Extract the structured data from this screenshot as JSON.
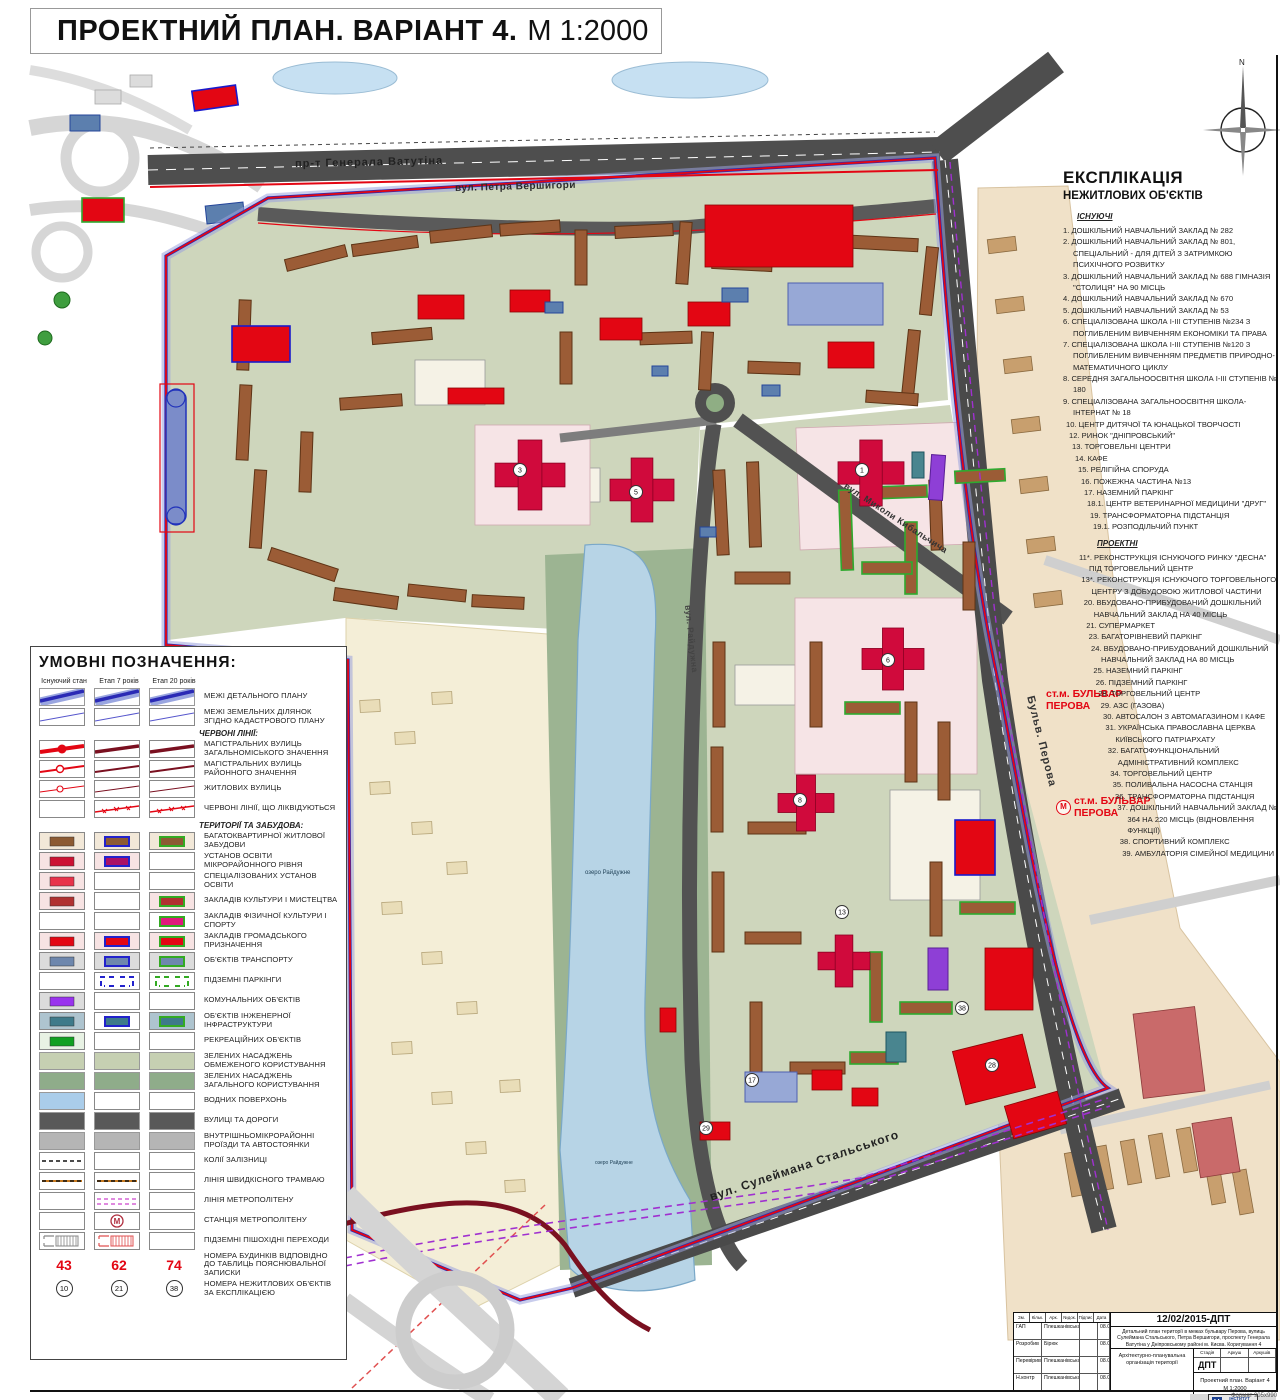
{
  "title": {
    "main": "ПРОЕКТНИЙ ПЛАН. ВАРІАНТ 4.",
    "scale": "М 1:2000"
  },
  "compass": {
    "north": "N"
  },
  "map_labels": {
    "street_vatutina": "пр-т Генерала Ватутіна",
    "street_vershygory": "вул. Петра Вершигори",
    "street_kybalchycha": "вул. Миколи Кибальчича",
    "street_raiduzhna": "вул. Райдужна",
    "street_stalskogo": "вул. Сулеймана Стальського",
    "street_perova": "Бульв. Перова",
    "lake": "озеро Райдужне",
    "metro_station_1": "ст.м. БУЛЬВАР ПЕРОВА",
    "metro_station_2": "ст.м. БУЛЬВАР ПЕРОВА",
    "metro_symbol": "М"
  },
  "map_markers": [
    "3",
    "5",
    "1",
    "6",
    "8",
    "13",
    "17",
    "28",
    "29",
    "38"
  ],
  "colors": {
    "red_line": "#e30613",
    "dark_red_line": "#7a1020",
    "blue_line": "#2222b0",
    "boundary_band": "#9aa2dd",
    "road": "#4e4e4e",
    "water": "#b7d4e6",
    "green_limited": "#c6d0b2",
    "green_public": "#8fac8a",
    "metro_dash": "#a030d0"
  },
  "legend": {
    "title": "УМОВНІ ПОЗНАЧЕННЯ:",
    "columns": [
      "Існуючий стан",
      "Етап 7 років",
      "Етап 20 років"
    ],
    "rows": [
      {
        "type": "row",
        "label": "МЕЖІ ДЕТАЛЬНОГО ПЛАНУ",
        "cells": [
          "band_blue",
          "band_blue",
          "band_blue"
        ]
      },
      {
        "type": "row",
        "label": "МЕЖІ ЗЕМЕЛЬНИХ ДІЛЯНОК ЗГІДНО КАДАСТРОВОГО ПЛАНУ",
        "cells": [
          "line_blue",
          "line_blue",
          "line_blue"
        ]
      },
      {
        "type": "header",
        "label": "ЧЕРВОНІ ЛІНІЇ:"
      },
      {
        "type": "row",
        "label": "МАГІСТРАЛЬНИХ ВУЛИЦЬ ЗАГАЛЬНОМІСЬКОГО ЗНАЧЕННЯ",
        "cells": [
          "red_major_e",
          "red_major_p",
          "red_major_p"
        ]
      },
      {
        "type": "row",
        "label": "МАГІСТРАЛЬНИХ ВУЛИЦЬ РАЙОННОГО ЗНАЧЕННЯ",
        "cells": [
          "red_district_e",
          "red_district_p",
          "red_district_p"
        ]
      },
      {
        "type": "row",
        "label": "ЖИТЛОВИХ ВУЛИЦЬ",
        "cells": [
          "red_res_e",
          "red_res_p",
          "red_res_p"
        ]
      },
      {
        "type": "row",
        "label": "ЧЕРВОНІ ЛІНІЇ, ЩО ЛІКВІДУЮТЬСЯ",
        "cells": [
          "empty",
          "red_liq",
          "red_liq"
        ]
      },
      {
        "type": "header",
        "label": "ТЕРИТОРІЇ ТА ЗАБУДОВА:"
      },
      {
        "type": "row",
        "label": "БАГАТОКВАРТИРНОЇ ЖИТЛОВОЇ ЗАБУДОВИ",
        "cells": [
          "r:#f2e8d8/#8c5a33/none",
          "r:#f2e8d8/#8c5a33/#2222cc",
          "r:#f2e8d8/#8c5a33/#33aa22"
        ]
      },
      {
        "type": "row",
        "label": "УСТАНОВ ОСВІТИ МІКРОРАЙОННОГО РІВНЯ",
        "cells": [
          "r:#f7e3e3/#cc1133/none",
          "r:#f7e3e3/#aa1166/#2222cc",
          "empty"
        ]
      },
      {
        "type": "row",
        "label": "СПЕЦІАЛІЗОВАНИХ УСТАНОВ ОСВІТИ",
        "cells": [
          "r:#f7e3e3/#e8334a/none",
          "empty",
          "empty"
        ]
      },
      {
        "type": "row",
        "label": "ЗАКЛАДІВ КУЛЬТУРИ І МИСТЕЦТВА",
        "cells": [
          "r:#f7e3e3/#b03030/none",
          "empty",
          "r:#f7e3e3/#b03030/#33aa22"
        ]
      },
      {
        "type": "row",
        "label": "ЗАКЛАДІВ ФІЗИЧНОЇ КУЛЬТУРИ І СПОРТУ",
        "cells": [
          "empty",
          "empty",
          "r:#ffffff/#e0187c/#33aa22"
        ]
      },
      {
        "type": "row",
        "label": "ЗАКЛАДІВ ГРОМАДСЬКОГО ПРИЗНАЧЕННЯ",
        "cells": [
          "r:#f7e3e3/#e30613/none",
          "r:#f7e3e3/#e30613/#2222cc",
          "r:#f7e3e3/#e30613/#33aa22"
        ]
      },
      {
        "type": "row",
        "label": "ОБ'ЄКТІВ ТРАНСПОРТУ",
        "cells": [
          "r:#dcdcdc/#6e87ad/none",
          "r:#dcdcdc/#6e87ad/#2222cc",
          "r:#dcdcdc/#6e87ad/#33aa22"
        ]
      },
      {
        "type": "row",
        "label": "ПІДЗЕМНІ ПАРКІНГИ",
        "cells": [
          "empty",
          "bracket:#2222cc",
          "bracket:#33aa22"
        ]
      },
      {
        "type": "row",
        "label": "КОМУНАЛЬНИХ ОБ'ЄКТІВ",
        "cells": [
          "r:#dcdcdc/#9933ee/none",
          "empty",
          "empty"
        ]
      },
      {
        "type": "row",
        "label": "ОБ'ЄКТІВ ІНЖЕНЕРНОЇ ІНФРАСТРУКТУРИ",
        "cells": [
          "r:#aec4cf/#3e7a8a/none",
          "r:#ffffff/#3e7a8a/#2222cc",
          "r:#aec4cf/#3e7a8a/#33aa22"
        ]
      },
      {
        "type": "row",
        "label": "РЕКРЕАЦІЙНИХ ОБ'ЄКТІВ",
        "cells": [
          "r:#e8f2e4/#11a022/none",
          "empty",
          "empty"
        ]
      },
      {
        "type": "row",
        "label": "ЗЕЛЕНИХ НАСАДЖЕНЬ ОБМЕЖЕНОГО КОРИСТУВАННЯ",
        "cells": [
          "a:#c6d0b2",
          "a:#c6d0b2",
          "a:#c6d0b2"
        ]
      },
      {
        "type": "row",
        "label": "ЗЕЛЕНИХ НАСАДЖЕНЬ ЗАГАЛЬНОГО КОРИСТУВАННЯ",
        "cells": [
          "a:#8fac8a",
          "a:#8fac8a",
          "a:#8fac8a"
        ]
      },
      {
        "type": "row",
        "label": "ВОДНИХ ПОВЕРХОНЬ",
        "cells": [
          "a:#aacdea",
          "empty",
          "empty"
        ]
      },
      {
        "type": "row",
        "label": "ВУЛИЦІ ТА ДОРОГИ",
        "cells": [
          "a:#595959",
          "a:#595959",
          "a:#595959"
        ]
      },
      {
        "type": "row",
        "label": "ВНУТРІШНЬОМІКРОРАЙОННІ ПРОЇЗДИ ТА АВТОСТОЯНКИ",
        "cells": [
          "a:#b5b5b5",
          "a:#b5b5b5",
          "a:#b5b5b5"
        ]
      },
      {
        "type": "row",
        "label": "КОЛІЇ ЗАЛІЗНИЦІ",
        "cells": [
          "rail",
          "empty",
          "empty"
        ]
      },
      {
        "type": "row",
        "label": "ЛІНІЯ ШВИДКІСНОГО ТРАМВАЮ",
        "cells": [
          "tram",
          "tram",
          "empty"
        ]
      },
      {
        "type": "row",
        "label": "ЛІНІЯ МЕТРОПОЛІТЕНУ",
        "cells": [
          "empty",
          "metro_line",
          "empty"
        ]
      },
      {
        "type": "row",
        "label": "СТАНЦІЯ МЕТРОПОЛІТЕНУ",
        "cells": [
          "empty",
          "metro_station",
          "empty"
        ]
      },
      {
        "type": "row",
        "label": "ПІДЗЕМНІ ПІШОХІДНІ ПЕРЕХОДИ",
        "cells": [
          "underpass:#888888",
          "underpass:#e05050",
          "empty"
        ]
      },
      {
        "type": "nums",
        "label": "НОМЕРА БУДИНКІВ ВІДПОВІДНО ДО ТАБЛИЦЬ ПОЯСНЮВАЛЬНОЇ ЗАПИСКИ",
        "values": [
          "43",
          "62",
          "74"
        ]
      },
      {
        "type": "circs",
        "label": "НОМЕРА НЕЖИТЛОВИХ ОБ'ЄКТІВ ЗА ЕКСПЛІКАЦІЄЮ",
        "values": [
          "10",
          "21",
          "38"
        ]
      }
    ],
    "metro_letter": "М"
  },
  "explication": {
    "title1": "ЕКСПЛІКАЦІЯ",
    "title2": "НЕЖИТЛОВИХ ОБ'ЄКТІВ",
    "section_existing": "ІСНУЮЧІ",
    "existing": [
      "1. ДОШКІЛЬНИЙ НАВЧАЛЬНИЙ ЗАКЛАД № 282",
      "2. ДОШКІЛЬНИЙ НАВЧАЛЬНИЙ ЗАКЛАД № 801, СПЕЦІАЛЬНИЙ - ДЛЯ ДІТЕЙ З ЗАТРИМКОЮ ПСИХІЧНОГО РОЗВИТКУ",
      "3. ДОШКІЛЬНИЙ НАВЧАЛЬНИЙ ЗАКЛАД № 688 ГІМНАЗІЯ \"СТОЛИЦЯ\" НА 90 МІСЦЬ",
      "4. ДОШКІЛЬНИЙ НАВЧАЛЬНИЙ ЗАКЛАД № 670",
      "5. ДОШКІЛЬНИЙ НАВЧАЛЬНИЙ ЗАКЛАД № 53",
      "6. СПЕЦІАЛІЗОВАНА ШКОЛА І-ІІІ СТУПЕНІВ №234 З ПОГЛИБЛЕНИМ ВИВЧЕННЯМ ЕКОНОМІКИ ТА ПРАВА",
      "7. СПЕЦІАЛІЗОВАНА ШКОЛА І-ІІІ СТУПЕНІВ №120 З ПОГЛИБЛЕНИМ ВИВЧЕННЯМ ПРЕДМЕТІВ ПРИРОДНО-МАТЕМАТИЧНОГО ЦИКЛУ",
      "8. СЕРЕДНЯ ЗАГАЛЬНООСВІТНЯ ШКОЛА І-ІІІ СТУПЕНІВ № 180",
      "9. СПЕЦІАЛІЗОВАНА ЗАГАЛЬНООСВІТНЯ ШКОЛА-ІНТЕРНАТ № 18",
      "10. ЦЕНТР ДИТЯЧОЇ ТА ЮНАЦЬКОЇ ТВОРЧОСТІ",
      "12. РИНОК \"ДНІПРОВСЬКИЙ\"",
      "13. ТОРГОВЕЛЬНІ ЦЕНТРИ",
      "14. КАФЕ",
      "15. РЕЛІГІЙНА СПОРУДА",
      "16. ПОЖЕЖНА ЧАСТИНА №13",
      "17. НАЗЕМНИЙ ПАРКІНГ",
      "18.1. ЦЕНТР ВЕТЕРИНАРНОЇ МЕДИЦИНИ \"ДРУГ\"",
      "19. ТРАНСФОРМАТОРНА ПІДСТАНЦІЯ",
      "19.1. РОЗПОДІЛЬЧИЙ ПУНКТ"
    ],
    "section_projected": "ПРОЕКТНІ",
    "projected": [
      "11*. РЕКОНСТРУКЦІЯ ІСНУЮЧОГО РИНКУ \"ДЕСНА\" ПІД ТОРГОВЕЛЬНИЙ ЦЕНТР",
      "13*. РЕКОНСТРУКЦІЯ ІСНУЮЧОГО ТОРГОВЕЛЬНОГО ЦЕНТРУ З ДОБУДОВОЮ ЖИТЛОВОЇ ЧАСТИНИ",
      "20. ВБУДОВАНО-ПРИБУДОВАНИЙ ДОШКІЛЬНИЙ НАВЧАЛЬНИЙ ЗАКЛАД НА 40 МІСЦЬ",
      "21. СУПЕРМАРКЕТ",
      "23. БАГАТОРІВНЕВИЙ ПАРКІНГ",
      "24. ВБУДОВАНО-ПРИБУДОВАНИЙ ДОШКІЛЬНИЙ НАВЧАЛЬНИЙ ЗАКЛАД НА 80 МІСЦЬ",
      "25. НАЗЕМНИЙ ПАРКІНГ",
      "26. ПІДЗЕМНИЙ ПАРКІНГ",
      "28. ТОРГОВЕЛЬНИЙ ЦЕНТР",
      "29. АЗС (ГАЗОВА)",
      "30. АВТОСАЛОН З АВТОМАГАЗИНОМ І КАФЕ",
      "31. УКРАЇНСЬКА ПРАВОСЛАВНА ЦЕРКВА КИЇВСЬКОГО ПАТРІАРХАТУ",
      "32. БАГАТОФУНКЦІОНАЛЬНИЙ АДМІНІСТРАТИВНИЙ КОМПЛЕКС",
      "34. ТОРГОВЕЛЬНИЙ ЦЕНТР",
      "35. ПОЛИВАЛЬНА НАСОСНА СТАНЦІЯ",
      "36. ТРАНСФОРМАТОРНА ПІДСТАНЦІЯ",
      "37. ДОШКІЛЬНИЙ НАВЧАЛЬНИЙ ЗАКЛАД № 364 НА 220 МІСЦЬ (ВІДНОВЛЕННЯ ФУНКЦІЇ)",
      "38. СПОРТИВНИЙ КОМПЛЕКС",
      "39. АМБУЛАТОРІЯ СІМЕЙНОЇ МЕДИЦИНИ"
    ]
  },
  "stamp": {
    "date_code": "12/02/2015-ДПТ",
    "description": "Детальний план території в межах бульвару Перова, вулиць Сулеймана Стальського, Петра Вершигори, проспекту Генерала Ватутіна у Дніпровському районі м. Києва. Коригування 4",
    "head_cols": [
      "Зм.",
      "Кільк.",
      "Арк.",
      "№док.",
      "Підпис",
      "Дата"
    ],
    "rows": [
      [
        "ГАП",
        "Плешканівська",
        "08.09.17"
      ],
      [
        "Розробив",
        "Бірюк",
        "08.09.17"
      ],
      [
        "Перевірив",
        "Плешканівська",
        "08.09.17"
      ],
      [
        "Н.контр",
        "Плешканівська",
        "08.09.17"
      ]
    ],
    "subject": "Архітектурно-планувальна організація території",
    "stage_label": "Стадія",
    "sheet_label": "Аркуш",
    "sheets_label": "Аркушів",
    "stage_value": "ДПТ",
    "drawing_title_1": "Проектний план. Варіант 4",
    "drawing_title_2": "М 1:2000",
    "org_line1": "ІНСТИТУТ",
    "org_line2": "УРБАНІСТИКИ",
    "org_line3": "КИЇВ-2017",
    "org_logo_letter": "U",
    "format_note": "Формат 905х990"
  }
}
